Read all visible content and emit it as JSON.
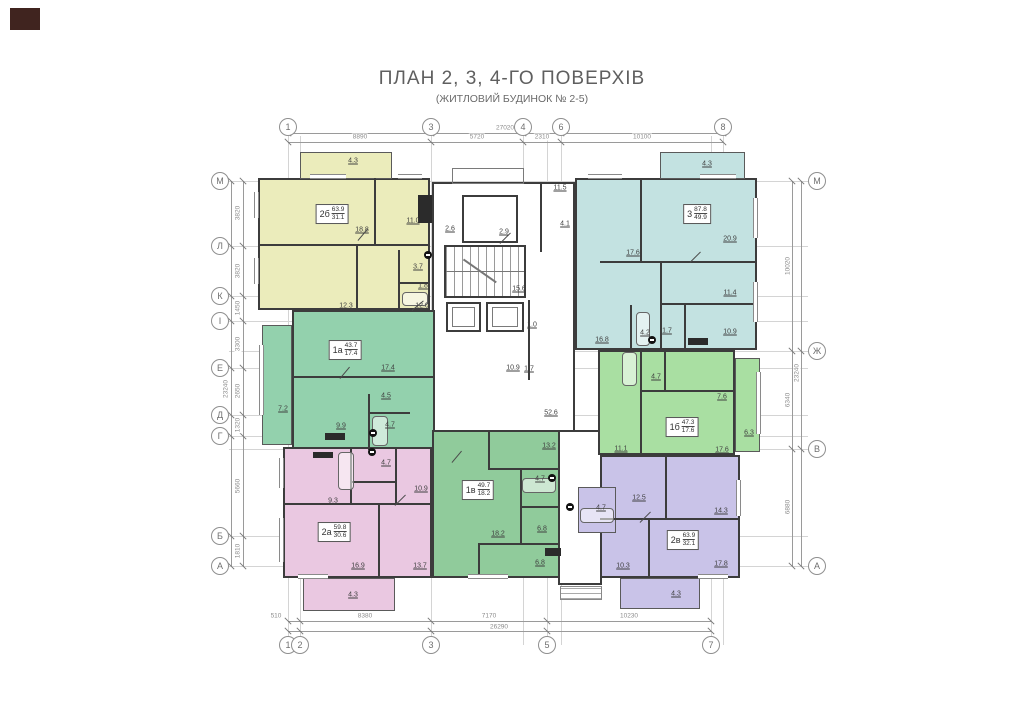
{
  "title": {
    "main": "ПЛАН 2, 3, 4-ГО ПОВЕРХІВ",
    "sub": "(ЖИТЛОВИЙ БУДИНОК № 2-5)"
  },
  "axis_markers": {
    "top": [
      {
        "label": "1",
        "x": 288
      },
      {
        "label": "3",
        "x": 431
      },
      {
        "label": "4",
        "x": 523
      },
      {
        "label": "6",
        "x": 561
      },
      {
        "label": "8",
        "x": 723
      }
    ],
    "bottom": [
      {
        "label": "1",
        "x": 288
      },
      {
        "label": "2",
        "x": 300
      },
      {
        "label": "3",
        "x": 431
      },
      {
        "label": "5",
        "x": 547
      },
      {
        "label": "7",
        "x": 711
      }
    ],
    "left": [
      {
        "label": "М",
        "y": 181
      },
      {
        "label": "Л",
        "y": 246
      },
      {
        "label": "К",
        "y": 296
      },
      {
        "label": "І",
        "y": 321
      },
      {
        "label": "Е",
        "y": 368
      },
      {
        "label": "Д",
        "y": 415
      },
      {
        "label": "Г",
        "y": 436
      },
      {
        "label": "Б",
        "y": 536
      },
      {
        "label": "А",
        "y": 566
      }
    ],
    "right": [
      {
        "label": "М",
        "y": 181
      },
      {
        "label": "Ж",
        "y": 351
      },
      {
        "label": "В",
        "y": 449
      },
      {
        "label": "А",
        "y": 566
      }
    ]
  },
  "dimensions": {
    "top": {
      "total": {
        "value": "27020",
        "x": 505,
        "y": 128,
        "rot": false
      },
      "segments": [
        {
          "value": "8890",
          "x": 360,
          "y": 137,
          "rot": false
        },
        {
          "value": "5720",
          "x": 477,
          "y": 137,
          "rot": false
        },
        {
          "value": "2310",
          "x": 542,
          "y": 137,
          "rot": false
        },
        {
          "value": "10100",
          "x": 642,
          "y": 137,
          "rot": false
        }
      ]
    },
    "bottom": {
      "total": {
        "value": "26290",
        "x": 499,
        "y": 627,
        "rot": false
      },
      "segments": [
        {
          "value": "510",
          "x": 276,
          "y": 616,
          "rot": false
        },
        {
          "value": "8380",
          "x": 365,
          "y": 616,
          "rot": false
        },
        {
          "value": "7170",
          "x": 489,
          "y": 616,
          "rot": false
        },
        {
          "value": "10230",
          "x": 629,
          "y": 616,
          "rot": false
        }
      ]
    },
    "left": {
      "total": {
        "value": "23240",
        "x": 226,
        "y": 389,
        "rot": true
      },
      "segments": [
        {
          "value": "3820",
          "x": 238,
          "y": 213,
          "rot": true
        },
        {
          "value": "3820",
          "x": 238,
          "y": 271,
          "rot": true
        },
        {
          "value": "1450",
          "x": 238,
          "y": 308,
          "rot": true
        },
        {
          "value": "3300",
          "x": 238,
          "y": 344,
          "rot": true
        },
        {
          "value": "2650",
          "x": 238,
          "y": 391,
          "rot": true
        },
        {
          "value": "1320",
          "x": 238,
          "y": 425,
          "rot": true
        },
        {
          "value": "5660",
          "x": 238,
          "y": 486,
          "rot": true
        },
        {
          "value": "1810",
          "x": 238,
          "y": 551,
          "rot": true
        }
      ]
    },
    "right": {
      "total": {
        "value": "23240",
        "x": 797,
        "y": 373,
        "rot": true
      },
      "segments": [
        {
          "value": "10020",
          "x": 788,
          "y": 266,
          "rot": true
        },
        {
          "value": "6340",
          "x": 788,
          "y": 400,
          "rot": true
        },
        {
          "value": "6880",
          "x": 788,
          "y": 507,
          "rot": true
        }
      ]
    }
  },
  "apartments": [
    {
      "name": "2б",
      "area_total": "63.9",
      "area_living": "31.1",
      "color": "#ebecbb",
      "box": {
        "x": 332,
        "y": 214
      },
      "rooms": [
        {
          "value": "18.8",
          "x": 362,
          "y": 230
        },
        {
          "value": "11.0",
          "x": 413,
          "y": 221
        },
        {
          "value": "12.3",
          "x": 346,
          "y": 306
        },
        {
          "value": "12.0",
          "x": 422,
          "y": 306
        },
        {
          "value": "3.7",
          "x": 418,
          "y": 267
        },
        {
          "value": "1.8",
          "x": 423,
          "y": 286
        },
        {
          "value": "4.3",
          "x": 353,
          "y": 161
        }
      ]
    },
    {
      "name": "3",
      "area_total": "87.8",
      "area_living": "49.9",
      "color": "#c3e2e1",
      "box": {
        "x": 697,
        "y": 214
      },
      "rooms": [
        {
          "value": "17.6",
          "x": 633,
          "y": 253
        },
        {
          "value": "20.9",
          "x": 730,
          "y": 239
        },
        {
          "value": "11.4",
          "x": 730,
          "y": 293
        },
        {
          "value": "10.9",
          "x": 730,
          "y": 332
        },
        {
          "value": "16.8",
          "x": 602,
          "y": 340
        },
        {
          "value": "4.2",
          "x": 645,
          "y": 333
        },
        {
          "value": "1.7",
          "x": 667,
          "y": 331
        },
        {
          "value": "4.3",
          "x": 707,
          "y": 164
        }
      ]
    },
    {
      "name": "1а",
      "area_total": "43.7",
      "area_living": "17.4",
      "color": "#93d1ad",
      "box": {
        "x": 345,
        "y": 350
      },
      "rooms": [
        {
          "value": "17.4",
          "x": 388,
          "y": 368
        },
        {
          "value": "4.5",
          "x": 386,
          "y": 396
        },
        {
          "value": "9.9",
          "x": 341,
          "y": 426
        },
        {
          "value": "4.7",
          "x": 390,
          "y": 425
        },
        {
          "value": "7.2",
          "x": 283,
          "y": 409
        }
      ]
    },
    {
      "name": "1б",
      "area_total": "47.3",
      "area_living": "17.6",
      "color": "#a9dfa2",
      "box": {
        "x": 682,
        "y": 427
      },
      "rooms": [
        {
          "value": "4.7",
          "x": 656,
          "y": 377
        },
        {
          "value": "7.6",
          "x": 722,
          "y": 397
        },
        {
          "value": "11.1",
          "x": 621,
          "y": 449
        },
        {
          "value": "17.6",
          "x": 722,
          "y": 450
        },
        {
          "value": "6.3",
          "x": 749,
          "y": 433
        }
      ]
    },
    {
      "name": "2а",
      "area_total": "59.8",
      "area_living": "30.6",
      "color": "#eac8e1",
      "box": {
        "x": 334,
        "y": 532
      },
      "rooms": [
        {
          "value": "9.3",
          "x": 333,
          "y": 501
        },
        {
          "value": "10.9",
          "x": 421,
          "y": 489
        },
        {
          "value": "4.7",
          "x": 386,
          "y": 463
        },
        {
          "value": "16.9",
          "x": 358,
          "y": 566
        },
        {
          "value": "13.7",
          "x": 420,
          "y": 566
        },
        {
          "value": "4.3",
          "x": 353,
          "y": 595
        }
      ]
    },
    {
      "name": "1в",
      "area_total": "49.7",
      "area_living": "18.2",
      "color": "#90cb9b",
      "box": {
        "x": 478,
        "y": 490
      },
      "rooms": [
        {
          "value": "13.2",
          "x": 549,
          "y": 446
        },
        {
          "value": "4.7",
          "x": 540,
          "y": 479
        },
        {
          "value": "18.2",
          "x": 498,
          "y": 534
        },
        {
          "value": "6.8",
          "x": 542,
          "y": 529
        },
        {
          "value": "6.8",
          "x": 540,
          "y": 563
        }
      ]
    },
    {
      "name": "2в",
      "area_total": "63.9",
      "area_living": "32.1",
      "color": "#c9c3e8",
      "box": {
        "x": 683,
        "y": 540
      },
      "rooms": [
        {
          "value": "12.5",
          "x": 639,
          "y": 498
        },
        {
          "value": "14.3",
          "x": 721,
          "y": 511
        },
        {
          "value": "10.3",
          "x": 623,
          "y": 566
        },
        {
          "value": "17.8",
          "x": 721,
          "y": 564
        },
        {
          "value": "4.7",
          "x": 601,
          "y": 508
        },
        {
          "value": "4.3",
          "x": 676,
          "y": 594
        }
      ]
    }
  ],
  "common_areas": {
    "rooms": [
      {
        "value": "2.9",
        "x": 504,
        "y": 232
      },
      {
        "value": "2.6",
        "x": 450,
        "y": 229
      },
      {
        "value": "11.5",
        "x": 560,
        "y": 188
      },
      {
        "value": "4.1",
        "x": 565,
        "y": 224
      },
      {
        "value": "15.6",
        "x": 519,
        "y": 289
      },
      {
        "value": "1.0",
        "x": 532,
        "y": 325
      },
      {
        "value": "10.9",
        "x": 513,
        "y": 368
      },
      {
        "value": "1.7",
        "x": 529,
        "y": 369
      },
      {
        "value": "52.6",
        "x": 551,
        "y": 413
      }
    ]
  },
  "palette": {
    "walls": "#3c3c3c",
    "dim_text": "#8c8c8c",
    "room_text": "#3f3f3f"
  }
}
